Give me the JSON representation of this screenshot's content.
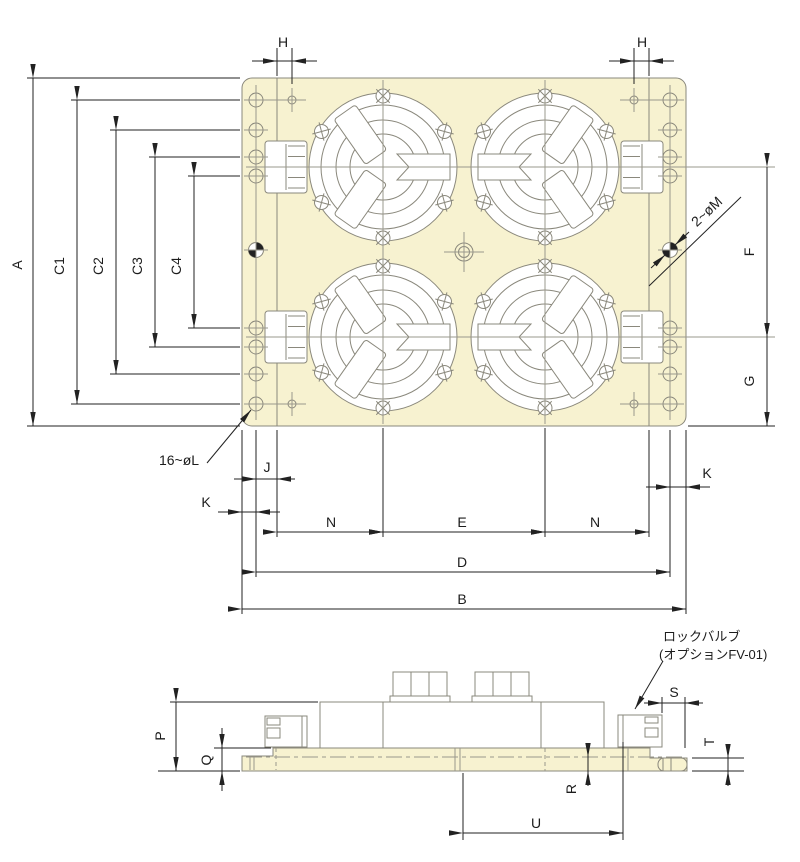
{
  "colors": {
    "plate_fill": "#f7f2d0",
    "outline_gray": "#8a887c",
    "dimension_black": "#222222"
  },
  "top_view": {
    "dim_labels": {
      "A": "A",
      "C1": "C1",
      "C2": "C2",
      "C3": "C3",
      "C4": "C4",
      "H": "H",
      "J": "J",
      "K": "K",
      "N": "N",
      "E": "E",
      "D": "D",
      "B": "B",
      "F": "F",
      "G": "G"
    },
    "callouts": {
      "holes_l": "16~øL",
      "holes_m": "2~øM"
    }
  },
  "side_view": {
    "dim_labels": {
      "P": "P",
      "Q": "Q",
      "R": "R",
      "S": "S",
      "T": "T",
      "U": "U"
    },
    "lock_valve_note": [
      "ロックバルブ",
      "(オプションFV-01)"
    ]
  }
}
